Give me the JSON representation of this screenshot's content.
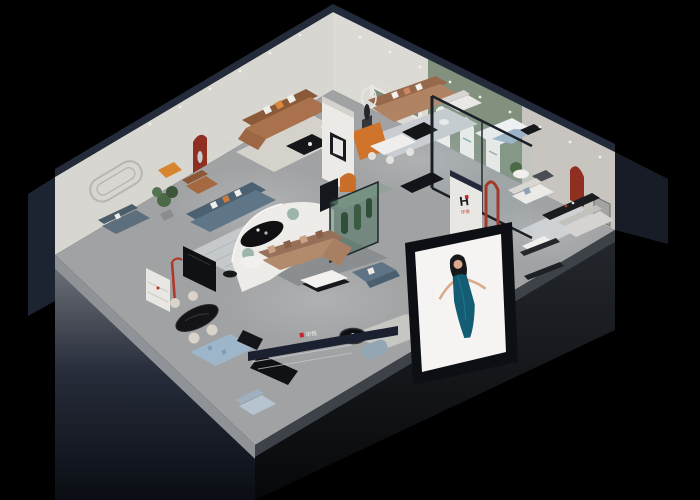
{
  "scene": {
    "title": "Isometric cutaway 3D render of a furniture showroom at night",
    "background": "#000000"
  },
  "brand": {
    "logo_letter": "H",
    "name_cn": "华悦",
    "logo_red": "#c1272d",
    "logo_blue": "#2e6fb0"
  },
  "signage": {
    "back_wall_dots": "·····",
    "ne_wall_dots": "·····",
    "arch_caption_dots": "···",
    "fascia_text": "华悦",
    "partition_text": "华悦"
  },
  "poster": {
    "subject": "woman in teal evening dress",
    "caption_vertical": "·····"
  },
  "palette": {
    "outer_wall_navy": "#232b3a",
    "wall_light": "#d8d6d1",
    "sage_green": "#81917e",
    "accent_red": "#8e2f22",
    "sofa_tan": "#b18a6b",
    "sofa_brown": "#a9724c",
    "sofa_slate": "#5e7687",
    "sofa_blue": "#b6c4d2",
    "floor_gray": "#a0a2a3"
  }
}
